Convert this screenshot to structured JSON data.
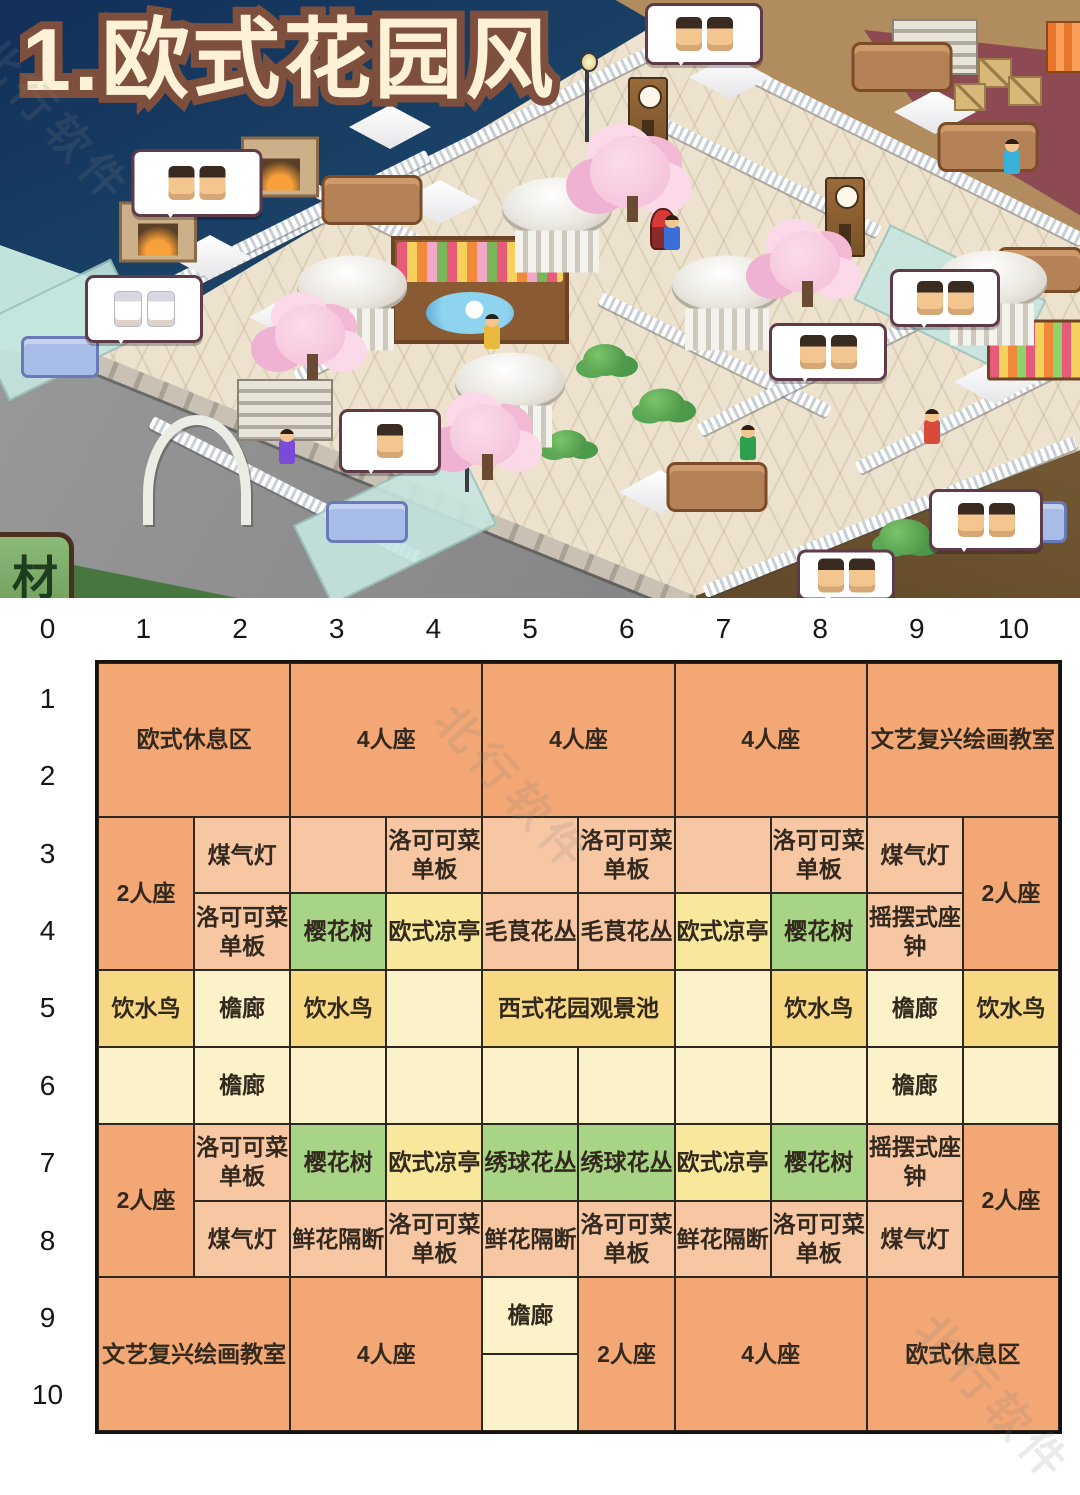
{
  "title": "1.欧式花园风",
  "watermark_text": "北行软件",
  "scene": {
    "material_button": "材",
    "objects": [
      {
        "type": "stone_wall",
        "x": 392,
        "y": 483,
        "w": 650,
        "r": 22
      },
      {
        "type": "railing",
        "x": 375,
        "y": 190,
        "w": 630,
        "r": -26.5
      },
      {
        "type": "railing",
        "x": 868,
        "y": 133,
        "w": 480,
        "r": 26.5
      },
      {
        "type": "railing",
        "x": 285,
        "y": 227,
        "w": 320,
        "r": -26.5
      },
      {
        "type": "railing",
        "x": 365,
        "y": 215,
        "w": 255,
        "r": 26.5
      },
      {
        "type": "railing",
        "x": 765,
        "y": 175,
        "w": 255,
        "r": 26.5
      },
      {
        "type": "railing",
        "x": 715,
        "y": 355,
        "w": 255,
        "r": 26.5
      },
      {
        "type": "railing",
        "x": 430,
        "y": 310,
        "w": 300,
        "r": -26.5
      },
      {
        "type": "railing",
        "x": 285,
        "y": 490,
        "w": 300,
        "r": 27
      },
      {
        "type": "railing",
        "x": 825,
        "y": 368,
        "w": 280,
        "r": -26.5
      },
      {
        "type": "railing",
        "x": 965,
        "y": 415,
        "w": 240,
        "r": -26.5
      },
      {
        "type": "railing",
        "x": 890,
        "y": 517,
        "w": 400,
        "r": -22
      },
      {
        "type": "room_teal",
        "x": 60,
        "y": 330,
        "w": 150,
        "h": 80,
        "r": -26
      },
      {
        "type": "room_teal",
        "x": 395,
        "y": 525,
        "w": 180,
        "h": 85,
        "r": -26
      },
      {
        "type": "room_teal",
        "x": 950,
        "y": 300,
        "w": 170,
        "h": 80,
        "r": 26
      },
      {
        "type": "stairs",
        "x": 285,
        "y": 410,
        "w": 92,
        "h": 58
      },
      {
        "type": "stairs",
        "x": 935,
        "y": 47,
        "w": 82,
        "h": 52
      },
      {
        "type": "arch",
        "x": 197,
        "y": 470,
        "w": 88,
        "h": 100
      },
      {
        "type": "table",
        "x": 390,
        "y": 127,
        "w": 82,
        "h": 44
      },
      {
        "type": "table",
        "x": 210,
        "y": 257,
        "w": 82,
        "h": 44
      },
      {
        "type": "table",
        "x": 290,
        "y": 317,
        "w": 82,
        "h": 44
      },
      {
        "type": "table",
        "x": 730,
        "y": 77,
        "w": 82,
        "h": 44
      },
      {
        "type": "table",
        "x": 935,
        "y": 112,
        "w": 82,
        "h": 44
      },
      {
        "type": "table",
        "x": 660,
        "y": 492,
        "w": 82,
        "h": 44
      },
      {
        "type": "table",
        "x": 995,
        "y": 382,
        "w": 82,
        "h": 44
      },
      {
        "type": "table",
        "x": 440,
        "y": 202,
        "w": 82,
        "h": 44
      },
      {
        "type": "sofa",
        "x": 372,
        "y": 200,
        "w": 95,
        "h": 44
      },
      {
        "type": "sofa",
        "x": 902,
        "y": 67,
        "w": 95,
        "h": 44
      },
      {
        "type": "sofa",
        "x": 988,
        "y": 147,
        "w": 95,
        "h": 44
      },
      {
        "type": "sofa",
        "x": 1040,
        "y": 270,
        "w": 80,
        "h": 40
      },
      {
        "type": "sofa",
        "x": 717,
        "y": 487,
        "w": 95,
        "h": 44
      },
      {
        "type": "blue_sofa",
        "x": 60,
        "y": 357,
        "w": 72,
        "h": 36
      },
      {
        "type": "blue_sofa",
        "x": 367,
        "y": 522,
        "w": 76,
        "h": 36
      },
      {
        "type": "blue_sofa",
        "x": 1025,
        "y": 522,
        "w": 78,
        "h": 36
      },
      {
        "type": "fireplace",
        "x": 280,
        "y": 167,
        "w": 72,
        "h": 55
      },
      {
        "type": "fireplace",
        "x": 158,
        "y": 232,
        "w": 72,
        "h": 55
      },
      {
        "type": "clock",
        "x": 648,
        "y": 115,
        "w": 36,
        "h": 72
      },
      {
        "type": "clock",
        "x": 845,
        "y": 217,
        "w": 36,
        "h": 76
      },
      {
        "type": "lamp",
        "x": 587,
        "y": 97,
        "w": 16,
        "h": 90
      },
      {
        "type": "lamp",
        "x": 467,
        "y": 452,
        "w": 16,
        "h": 80
      },
      {
        "type": "crate",
        "x": 995,
        "y": 73,
        "w": 30,
        "h": 26
      },
      {
        "type": "crate",
        "x": 1025,
        "y": 91,
        "w": 30,
        "h": 26
      },
      {
        "type": "crate",
        "x": 970,
        "y": 97,
        "w": 28,
        "h": 24
      },
      {
        "type": "awning",
        "x": 1065,
        "y": 47,
        "w": 34,
        "h": 48
      },
      {
        "type": "flowerbed",
        "x": 480,
        "y": 290,
        "w": 170,
        "h": 100
      },
      {
        "type": "tulip_bed",
        "x": 1035,
        "y": 350,
        "w": 90,
        "h": 55
      },
      {
        "type": "bush",
        "x": 605,
        "y": 360,
        "w": 44,
        "h": 32
      },
      {
        "type": "bush",
        "x": 662,
        "y": 405,
        "w": 46,
        "h": 33
      },
      {
        "type": "bush",
        "x": 905,
        "y": 537,
        "w": 52,
        "h": 36
      },
      {
        "type": "bush",
        "x": 567,
        "y": 444,
        "w": 40,
        "h": 28
      },
      {
        "type": "gazebo",
        "x": 557,
        "y": 225,
        "w": 110,
        "h": 95
      },
      {
        "type": "gazebo",
        "x": 352,
        "y": 303,
        "w": 110,
        "h": 95
      },
      {
        "type": "gazebo",
        "x": 727,
        "y": 303,
        "w": 110,
        "h": 95
      },
      {
        "type": "gazebo",
        "x": 510,
        "y": 400,
        "w": 110,
        "h": 95
      },
      {
        "type": "gazebo",
        "x": 992,
        "y": 298,
        "w": 110,
        "h": 95
      },
      {
        "type": "cherry",
        "x": 630,
        "y": 172,
        "w": 80,
        "h": 72
      },
      {
        "type": "cherry",
        "x": 805,
        "y": 262,
        "w": 70,
        "h": 62
      },
      {
        "type": "cherry",
        "x": 310,
        "y": 335,
        "w": 70,
        "h": 62
      },
      {
        "type": "cherry",
        "x": 485,
        "y": 435,
        "w": 70,
        "h": 62
      },
      {
        "type": "pig",
        "x": 701,
        "y": 43,
        "w": 26,
        "h": 26
      },
      {
        "type": "bird",
        "x": 663,
        "y": 229,
        "w": 22,
        "h": 38
      },
      {
        "type": "character",
        "x": 672,
        "y": 238,
        "w": 16,
        "h": 24,
        "c": "#3a6fd8"
      },
      {
        "type": "character",
        "x": 748,
        "y": 448,
        "w": 16,
        "h": 24,
        "c": "#2e9e4f"
      },
      {
        "type": "character",
        "x": 932,
        "y": 432,
        "w": 16,
        "h": 24,
        "c": "#d84a3a"
      },
      {
        "type": "character",
        "x": 492,
        "y": 337,
        "w": 16,
        "h": 24,
        "c": "#e8b93a"
      },
      {
        "type": "character",
        "x": 287,
        "y": 452,
        "w": 16,
        "h": 24,
        "c": "#7a4ad8"
      },
      {
        "type": "character",
        "x": 1012,
        "y": 162,
        "w": 16,
        "h": 24,
        "c": "#38b0d8"
      },
      {
        "type": "bubble",
        "x": 197,
        "y": 183,
        "w": 125,
        "h": 62,
        "faces": 2
      },
      {
        "type": "bubble",
        "x": 704,
        "y": 34,
        "w": 112,
        "h": 56,
        "faces": 2
      },
      {
        "type": "bubble",
        "x": 144,
        "y": 309,
        "w": 112,
        "h": 62,
        "faces": 2,
        "white": true
      },
      {
        "type": "bubble",
        "x": 390,
        "y": 441,
        "w": 96,
        "h": 58,
        "faces": 1
      },
      {
        "type": "bubble",
        "x": 828,
        "y": 352,
        "w": 112,
        "h": 52,
        "faces": 2
      },
      {
        "type": "bubble",
        "x": 945,
        "y": 298,
        "w": 104,
        "h": 52,
        "faces": 2
      },
      {
        "type": "bubble",
        "x": 986,
        "y": 520,
        "w": 108,
        "h": 56,
        "faces": 2
      },
      {
        "type": "bubble",
        "x": 846,
        "y": 575,
        "w": 92,
        "h": 45,
        "faces": 2
      }
    ]
  },
  "grid": {
    "column_labels": [
      "0",
      "1",
      "2",
      "3",
      "4",
      "5",
      "6",
      "7",
      "8",
      "9",
      "10"
    ],
    "row_labels": [
      "1",
      "2",
      "3",
      "4",
      "5",
      "6",
      "7",
      "8",
      "9",
      "10"
    ],
    "cells": [
      {
        "r": 1,
        "c": 1,
        "rs": 2,
        "cs": 2,
        "label": "欧式休息区",
        "color": "orange"
      },
      {
        "r": 1,
        "c": 3,
        "rs": 2,
        "cs": 2,
        "label": "4人座",
        "color": "orange"
      },
      {
        "r": 1,
        "c": 5,
        "rs": 2,
        "cs": 2,
        "label": "4人座",
        "color": "orange"
      },
      {
        "r": 1,
        "c": 7,
        "rs": 2,
        "cs": 2,
        "label": "4人座",
        "color": "orange"
      },
      {
        "r": 1,
        "c": 9,
        "rs": 2,
        "cs": 2,
        "label": "文艺复兴绘画教室",
        "color": "orange"
      },
      {
        "r": 3,
        "c": 1,
        "rs": 2,
        "cs": 1,
        "label": "2人座",
        "color": "orange"
      },
      {
        "r": 3,
        "c": 2,
        "rs": 1,
        "cs": 1,
        "label": "煤气灯",
        "color": "salmon"
      },
      {
        "r": 3,
        "c": 3,
        "rs": 1,
        "cs": 1,
        "label": "",
        "color": "salmon"
      },
      {
        "r": 3,
        "c": 4,
        "rs": 1,
        "cs": 1,
        "label": "洛可可菜单板",
        "color": "salmon"
      },
      {
        "r": 3,
        "c": 5,
        "rs": 1,
        "cs": 1,
        "label": "",
        "color": "salmon"
      },
      {
        "r": 3,
        "c": 6,
        "rs": 1,
        "cs": 1,
        "label": "洛可可菜单板",
        "color": "salmon"
      },
      {
        "r": 3,
        "c": 7,
        "rs": 1,
        "cs": 1,
        "label": "",
        "color": "salmon"
      },
      {
        "r": 3,
        "c": 8,
        "rs": 1,
        "cs": 1,
        "label": "洛可可菜单板",
        "color": "salmon"
      },
      {
        "r": 3,
        "c": 9,
        "rs": 1,
        "cs": 1,
        "label": "煤气灯",
        "color": "salmon"
      },
      {
        "r": 3,
        "c": 10,
        "rs": 2,
        "cs": 1,
        "label": "2人座",
        "color": "orange"
      },
      {
        "r": 4,
        "c": 2,
        "rs": 1,
        "cs": 1,
        "label": "洛可可菜单板",
        "color": "salmon"
      },
      {
        "r": 4,
        "c": 3,
        "rs": 1,
        "cs": 1,
        "label": "樱花树",
        "color": "green"
      },
      {
        "r": 4,
        "c": 4,
        "rs": 1,
        "cs": 1,
        "label": "欧式凉亭",
        "color": "yellow"
      },
      {
        "r": 4,
        "c": 5,
        "rs": 1,
        "cs": 1,
        "label": "毛茛花丛",
        "color": "salmon"
      },
      {
        "r": 4,
        "c": 6,
        "rs": 1,
        "cs": 1,
        "label": "毛茛花丛",
        "color": "salmon"
      },
      {
        "r": 4,
        "c": 7,
        "rs": 1,
        "cs": 1,
        "label": "欧式凉亭",
        "color": "yellow"
      },
      {
        "r": 4,
        "c": 8,
        "rs": 1,
        "cs": 1,
        "label": "樱花树",
        "color": "green"
      },
      {
        "r": 4,
        "c": 9,
        "rs": 1,
        "cs": 1,
        "label": "摇摆式座钟",
        "color": "salmon"
      },
      {
        "r": 5,
        "c": 1,
        "rs": 1,
        "cs": 1,
        "label": "饮水鸟",
        "color": "gold"
      },
      {
        "r": 5,
        "c": 2,
        "rs": 1,
        "cs": 1,
        "label": "檐廊",
        "color": "cream"
      },
      {
        "r": 5,
        "c": 3,
        "rs": 1,
        "cs": 1,
        "label": "饮水鸟",
        "color": "gold"
      },
      {
        "r": 5,
        "c": 4,
        "rs": 1,
        "cs": 1,
        "label": "",
        "color": "cream"
      },
      {
        "r": 5,
        "c": 5,
        "rs": 1,
        "cs": 2,
        "label": "西式花园观景池",
        "color": "gold"
      },
      {
        "r": 5,
        "c": 7,
        "rs": 1,
        "cs": 1,
        "label": "",
        "color": "cream"
      },
      {
        "r": 5,
        "c": 8,
        "rs": 1,
        "cs": 1,
        "label": "饮水鸟",
        "color": "gold"
      },
      {
        "r": 5,
        "c": 9,
        "rs": 1,
        "cs": 1,
        "label": "檐廊",
        "color": "cream"
      },
      {
        "r": 5,
        "c": 10,
        "rs": 1,
        "cs": 1,
        "label": "饮水鸟",
        "color": "gold"
      },
      {
        "r": 6,
        "c": 1,
        "rs": 1,
        "cs": 1,
        "label": "",
        "color": "cream"
      },
      {
        "r": 6,
        "c": 2,
        "rs": 1,
        "cs": 1,
        "label": "檐廊",
        "color": "cream"
      },
      {
        "r": 6,
        "c": 3,
        "rs": 1,
        "cs": 1,
        "label": "",
        "color": "cream"
      },
      {
        "r": 6,
        "c": 4,
        "rs": 1,
        "cs": 1,
        "label": "",
        "color": "cream"
      },
      {
        "r": 6,
        "c": 5,
        "rs": 1,
        "cs": 1,
        "label": "",
        "color": "cream"
      },
      {
        "r": 6,
        "c": 6,
        "rs": 1,
        "cs": 1,
        "label": "",
        "color": "cream"
      },
      {
        "r": 6,
        "c": 7,
        "rs": 1,
        "cs": 1,
        "label": "",
        "color": "cream"
      },
      {
        "r": 6,
        "c": 8,
        "rs": 1,
        "cs": 1,
        "label": "",
        "color": "cream"
      },
      {
        "r": 6,
        "c": 9,
        "rs": 1,
        "cs": 1,
        "label": "檐廊",
        "color": "cream"
      },
      {
        "r": 6,
        "c": 10,
        "rs": 1,
        "cs": 1,
        "label": "",
        "color": "cream"
      },
      {
        "r": 7,
        "c": 1,
        "rs": 2,
        "cs": 1,
        "label": "2人座",
        "color": "orange"
      },
      {
        "r": 7,
        "c": 2,
        "rs": 1,
        "cs": 1,
        "label": "洛可可菜单板",
        "color": "salmon"
      },
      {
        "r": 7,
        "c": 3,
        "rs": 1,
        "cs": 1,
        "label": "樱花树",
        "color": "green"
      },
      {
        "r": 7,
        "c": 4,
        "rs": 1,
        "cs": 1,
        "label": "欧式凉亭",
        "color": "yellow"
      },
      {
        "r": 7,
        "c": 5,
        "rs": 1,
        "cs": 1,
        "label": "绣球花丛",
        "color": "green"
      },
      {
        "r": 7,
        "c": 6,
        "rs": 1,
        "cs": 1,
        "label": "绣球花丛",
        "color": "green"
      },
      {
        "r": 7,
        "c": 7,
        "rs": 1,
        "cs": 1,
        "label": "欧式凉亭",
        "color": "yellow"
      },
      {
        "r": 7,
        "c": 8,
        "rs": 1,
        "cs": 1,
        "label": "樱花树",
        "color": "green"
      },
      {
        "r": 7,
        "c": 9,
        "rs": 1,
        "cs": 1,
        "label": "摇摆式座钟",
        "color": "salmon"
      },
      {
        "r": 7,
        "c": 10,
        "rs": 2,
        "cs": 1,
        "label": "2人座",
        "color": "orange"
      },
      {
        "r": 8,
        "c": 2,
        "rs": 1,
        "cs": 1,
        "label": "煤气灯",
        "color": "salmon"
      },
      {
        "r": 8,
        "c": 3,
        "rs": 1,
        "cs": 1,
        "label": "鲜花隔断",
        "color": "salmon"
      },
      {
        "r": 8,
        "c": 4,
        "rs": 1,
        "cs": 1,
        "label": "洛可可菜单板",
        "color": "salmon"
      },
      {
        "r": 8,
        "c": 5,
        "rs": 1,
        "cs": 1,
        "label": "鲜花隔断",
        "color": "salmon"
      },
      {
        "r": 8,
        "c": 6,
        "rs": 1,
        "cs": 1,
        "label": "洛可可菜单板",
        "color": "salmon"
      },
      {
        "r": 8,
        "c": 7,
        "rs": 1,
        "cs": 1,
        "label": "鲜花隔断",
        "color": "salmon"
      },
      {
        "r": 8,
        "c": 8,
        "rs": 1,
        "cs": 1,
        "label": "洛可可菜单板",
        "color": "salmon"
      },
      {
        "r": 8,
        "c": 9,
        "rs": 1,
        "cs": 1,
        "label": "煤气灯",
        "color": "salmon"
      },
      {
        "r": 9,
        "c": 1,
        "rs": 2,
        "cs": 2,
        "label": "文艺复兴绘画教室",
        "color": "orange"
      },
      {
        "r": 9,
        "c": 3,
        "rs": 2,
        "cs": 2,
        "label": "4人座",
        "color": "orange"
      },
      {
        "r": 9,
        "c": 5,
        "rs": 1,
        "cs": 1,
        "label": "檐廊",
        "color": "cream"
      },
      {
        "r": 10,
        "c": 5,
        "rs": 1,
        "cs": 1,
        "label": "",
        "color": "cream"
      },
      {
        "r": 9,
        "c": 6,
        "rs": 2,
        "cs": 1,
        "label": "2人座",
        "color": "orange"
      },
      {
        "r": 9,
        "c": 7,
        "rs": 2,
        "cs": 2,
        "label": "4人座",
        "color": "orange"
      },
      {
        "r": 9,
        "c": 9,
        "rs": 2,
        "cs": 2,
        "label": "欧式休息区",
        "color": "orange"
      }
    ]
  }
}
